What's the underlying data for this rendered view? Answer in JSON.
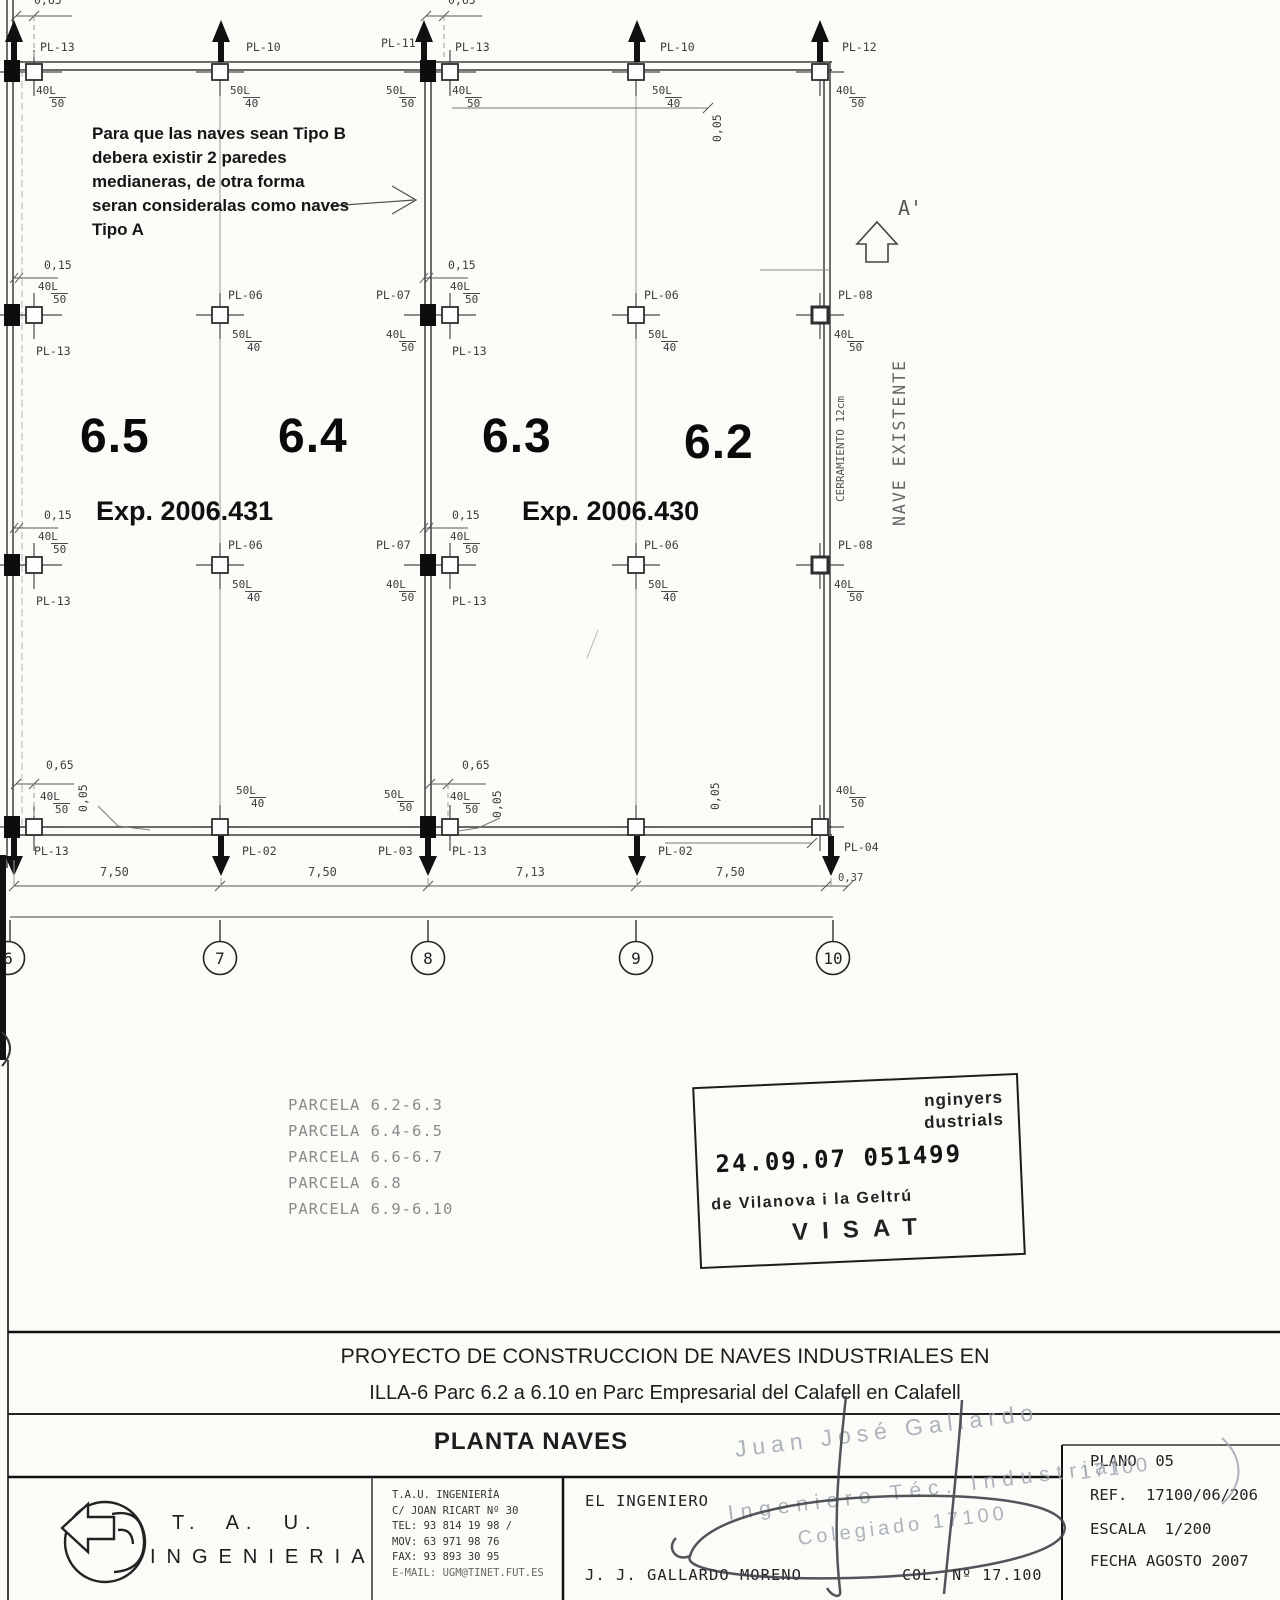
{
  "plan": {
    "pl": {
      "p02": "PL-02",
      "p03": "PL-03",
      "p04": "PL-04",
      "p06": "PL-06",
      "p07": "PL-07",
      "p08": "PL-08",
      "p10": "PL-10",
      "p11": "PL-11",
      "p12": "PL-12",
      "p13": "PL-13"
    },
    "sizes": {
      "n40": "40L",
      "n50": "50L",
      "d40": "40",
      "d50": "50"
    },
    "dims": {
      "d015": "0,15",
      "d065": "0,65",
      "d005": "0,05",
      "d750": "7,50",
      "d713": "7,13",
      "d037": "0,37"
    },
    "units": {
      "u65": "6.5",
      "u64": "6.4",
      "u63": "6.3",
      "u62": "6.2"
    },
    "exps": {
      "e431": "Exp. 2006.431",
      "e430": "Exp. 2006.430"
    },
    "annotations": {
      "note_l1": "Para que las naves sean Tipo B",
      "note_l2": "debera existir 2 paredes",
      "note_l3": "medianeras, de otra forma",
      "note_l4": "seran consideralas como naves",
      "note_l5": "Tipo A",
      "cerramiento": "CERRAMIENTO 12cm",
      "nave_existente": "NAVE EXISTENTE",
      "section": "A'"
    },
    "grid_bubbles": [
      "6",
      "7",
      "8",
      "9",
      "10"
    ]
  },
  "parcelas": [
    "PARCELA 6.2-6.3",
    "PARCELA 6.4-6.5",
    "PARCELA 6.6-6.7",
    "PARCELA 6.8",
    "PARCELA 6.9-6.10"
  ],
  "visat_stamp": {
    "top1": "nginyers",
    "top2": "dustrials",
    "number": "24.09.07 051499",
    "city": "de Vilanova i la Geltrú",
    "label": "VISAT"
  },
  "signature_stamp": {
    "name": "Juan José Gallardo",
    "role": "Ingeniero Téc. Industrial",
    "membership": "Colegiado 17100",
    "membership_short": "17100"
  },
  "title_block": {
    "title1": "PROYECTO DE CONSTRUCCION DE NAVES INDUSTRIALES EN",
    "title2": "ILLA-6 Parc 6.2 a 6.10 en Parc Empresarial del Calafell en Calafell",
    "drawing_name": "PLANTA NAVES",
    "logo_line1": "T.  A.  U.",
    "logo_line2": "INGENIERIA",
    "company": [
      "T.A.U. INGENIERÍA",
      "C/ JOAN RICART Nº 30",
      "TEL: 93 814 19 98 /",
      "MOV: 63 971 98 76",
      "FAX: 93 893 30 95",
      "E-MAIL: UGM@TINET.FUT.ES"
    ],
    "engineer_label": "EL INGENIERO",
    "engineer_name": "J. J. GALLARDO MORENO",
    "collegiate": "COL. Nº 17.100",
    "plano": "PLANO  05",
    "ref": "REF.  17100/06/206",
    "escala": "ESCALA  1/200",
    "fecha": "FECHA AGOSTO 2007"
  }
}
